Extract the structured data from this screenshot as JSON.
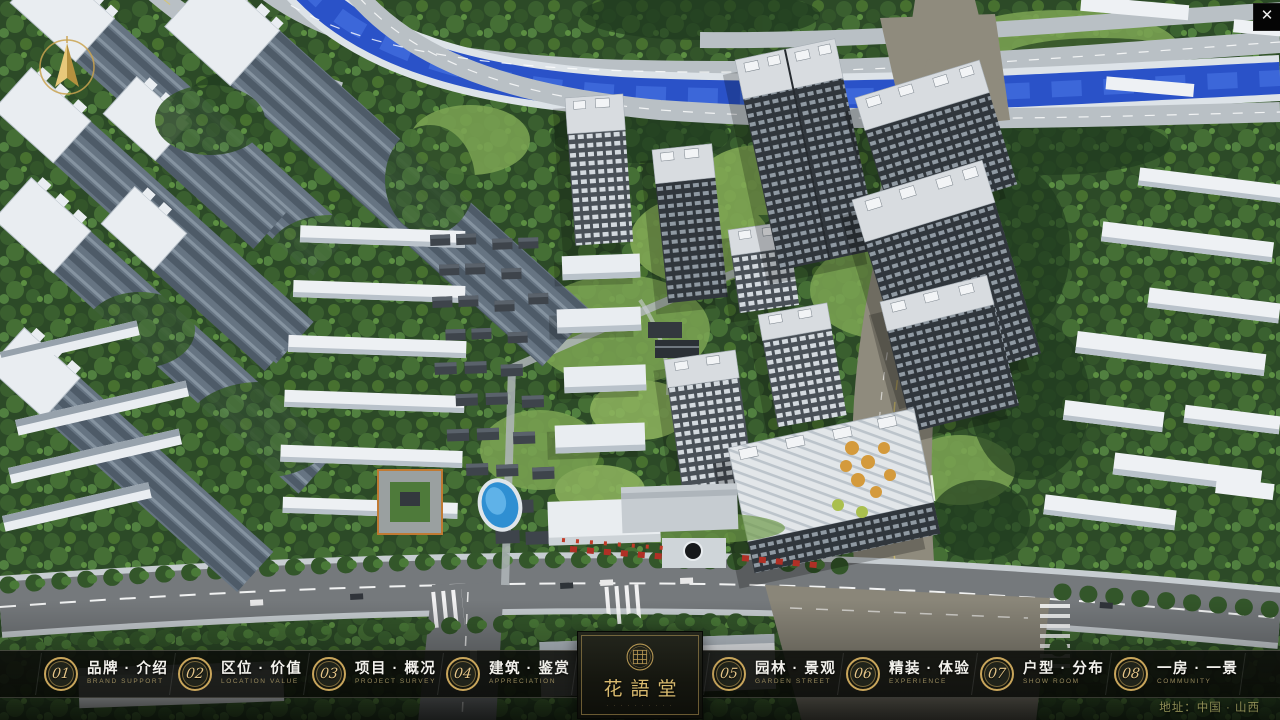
{
  "nav": {
    "items": [
      {
        "num": "01",
        "zh": "品牌 · 介绍",
        "en": "BRAND SUPPORT"
      },
      {
        "num": "02",
        "zh": "区位 · 价值",
        "en": "LOCATION VALUE"
      },
      {
        "num": "03",
        "zh": "项目 · 概况",
        "en": "PROJECT SURVEY"
      },
      {
        "num": "04",
        "zh": "建筑 · 鉴赏",
        "en": "APPRECIATION"
      },
      {
        "num": "05",
        "zh": "园林 · 景观",
        "en": "GARDEN STREET"
      },
      {
        "num": "06",
        "zh": "精装 · 体验",
        "en": "EXPERIENCE"
      },
      {
        "num": "07",
        "zh": "户型 · 分布",
        "en": "SHOW ROOM"
      },
      {
        "num": "08",
        "zh": "一房 · 一景",
        "en": "COMMUNITY"
      }
    ]
  },
  "logo": {
    "title": "花語堂",
    "tagline": "· · · · · · · · · ·"
  },
  "footer": {
    "address": "地址：中国 · 山西"
  },
  "window": {
    "close_glyph": "✕"
  },
  "icons": {
    "compass": "compass-north-icon",
    "close": "close-icon",
    "seal": "brand-seal-icon"
  },
  "theme": {
    "accent_gold": "#c8a55b",
    "logo_gold": "#d9ba6e",
    "nav_text": "#f2f1ec",
    "nav_subtext": "#97895d",
    "address_text": "#8f8e55",
    "river_blue": "#2a52c8",
    "tree_green": "#2c4a27"
  }
}
